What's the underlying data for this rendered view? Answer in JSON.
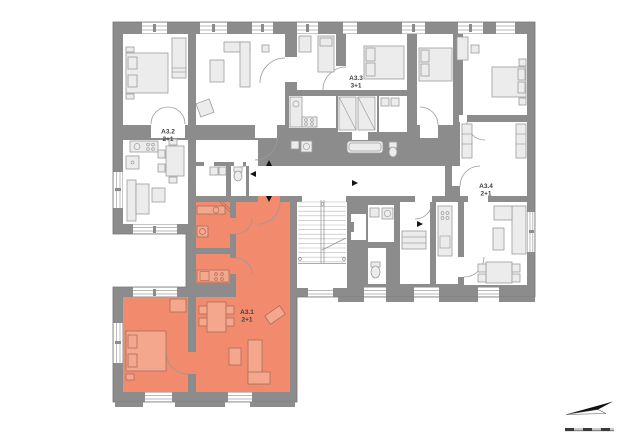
{
  "plan": {
    "apartments": [
      {
        "id": "A3.1",
        "layout": "2+1",
        "highlighted": true
      },
      {
        "id": "A3.2",
        "layout": "2+1",
        "highlighted": false
      },
      {
        "id": "A3.3",
        "layout": "3+1",
        "highlighted": false
      },
      {
        "id": "A3.4",
        "layout": "2+1",
        "highlighted": false
      }
    ],
    "colors": {
      "wall": "#8C8C8C",
      "room": "#FFFFFF",
      "highlight": "#F28A6E",
      "furniture": "#ECECEC",
      "furniture_highlight": "#F5A78E",
      "background": "#FFFFFF"
    },
    "compass": {
      "icon": "north-arrow",
      "scale_bar": "scale-bar"
    }
  }
}
